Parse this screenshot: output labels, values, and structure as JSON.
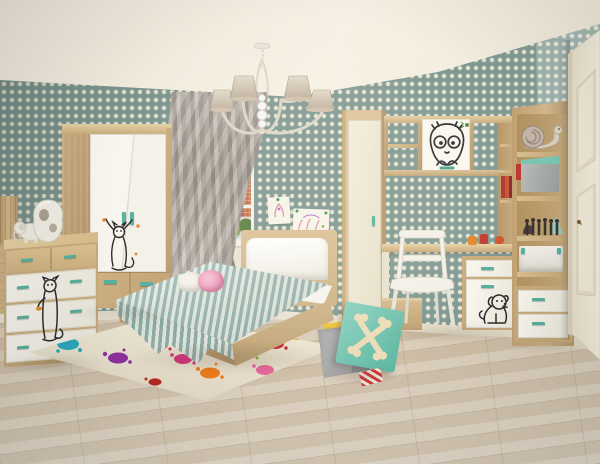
{
  "meta": {
    "type": "3d-interior-render",
    "subject": "children's bedroom furnished with a cat-doodle themed furniture set",
    "canvas": {
      "width": 600,
      "height": 464
    }
  },
  "palette": {
    "ceiling_cream": "#f2ecdf",
    "wallpaper_teal": "#7e9892",
    "wallpaper_dot": "#e9e4d2",
    "wallpaper_right_wall": "#8da6a0",
    "floor_wood": "#d9cbb5",
    "furniture_ash_wood": "#cfb488",
    "furniture_white_front": "#f8f5ee",
    "handle_teal": "#56b09d",
    "curtain_taupe": "#ab9f95",
    "bedding_stripe_teal": "#8fb2aa",
    "bedding_stripe_white": "#ecefe8",
    "rug_cream": "#ebe3d1",
    "toybox_lid_teal": "#6fc2ae",
    "toybox_interior_yellow": "#f0c83c",
    "toybox_body_gray": "#9fa3a5",
    "door_cream": "#ece5d2",
    "decal_ink": "#2b2b2b",
    "butterfly_orange": "#e08a2c",
    "fly_green": "#4f9440",
    "rug_splat_colors": [
      "#2aa7bd",
      "#8e2f9e",
      "#cf2b38",
      "#d6367f",
      "#ee7c1c",
      "#78b62e",
      "#c1272d",
      "#e8962a",
      "#e8679a",
      "#b5271f",
      "#e3bd2a"
    ]
  },
  "scene_objects": {
    "walls": "teal polka-dot wallpaper",
    "chandelier": "five-arm chandelier with beige fabric shades and crystal column",
    "window": "city view with brick apartment blocks and trees, gray swag curtain",
    "wardrobe": "two-door white and ash wardrobe with jumping-cat decal and two drawers",
    "chest_of_drawers": "ash chest with white drawers, teal handles, cat decal, white sculpture and elephant figurine on top",
    "bed": "single bed with white headboard cushion, teal striped throw and pink plush toys",
    "wall_art": "two pinned children's drawings",
    "rug": "cream rug with multicolor paint-splat pattern",
    "toy_box": "gray toy box with yellow interior, teal crossed-bones lid and striped ribbon",
    "desk_unit": "wall unit: tall cream cabinet, bridge shelves with cat-face cabinet door, desk, white chair, drawer pedestal with dog decal",
    "shelf_unit": "open shelf column with snail plush, boxes, dark figurines, storage box and two drawers",
    "door": "cream paneled door with keyhole"
  }
}
